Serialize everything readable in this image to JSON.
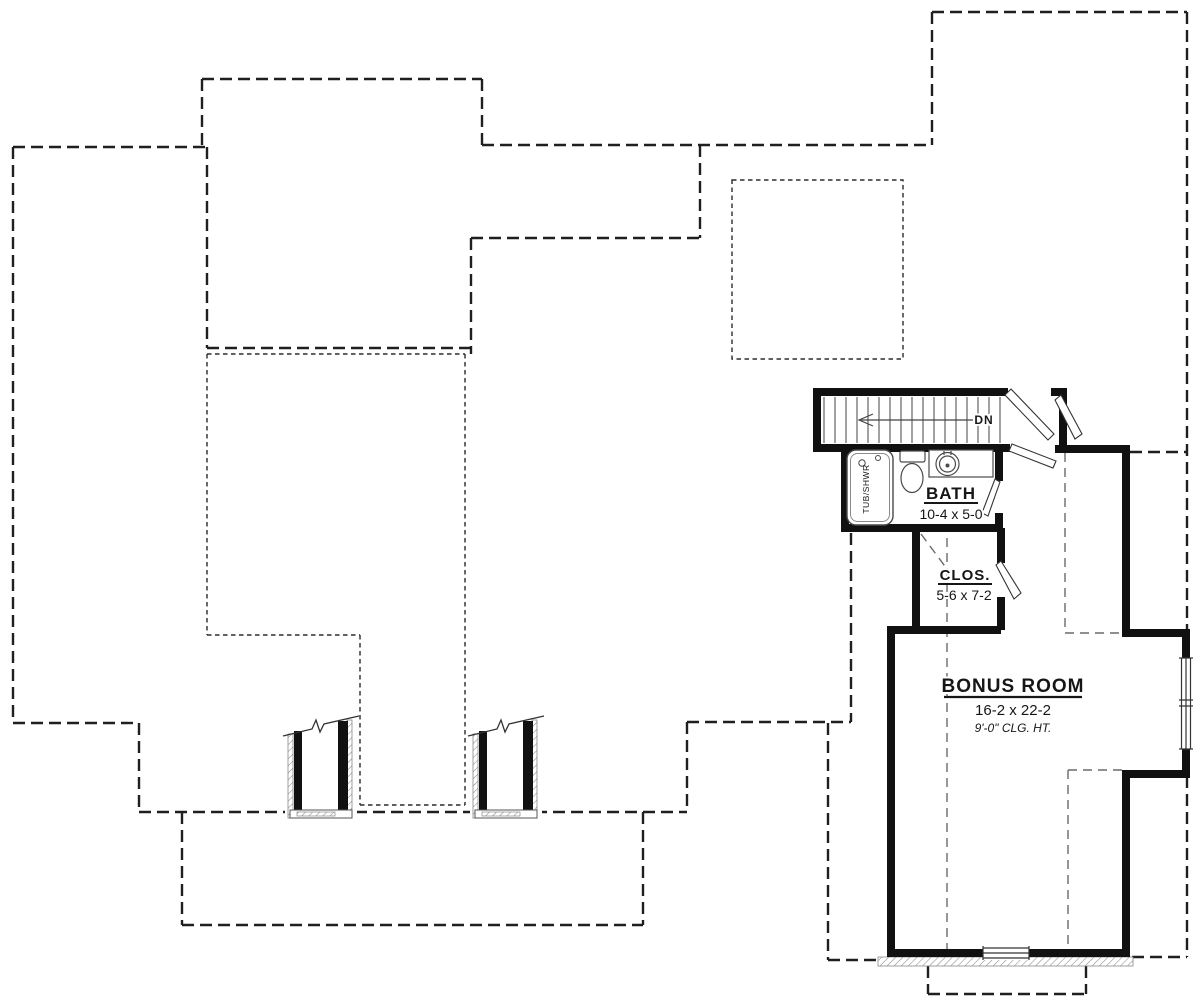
{
  "rooms": {
    "bath": {
      "name": "BATH",
      "dimensions": "10-4 x 5-0"
    },
    "closet": {
      "name": "CLOS.",
      "dimensions": "5-6 x 7-2"
    },
    "bonus": {
      "name": "BONUS ROOM",
      "dimensions": "16-2 x 22-2",
      "ceiling_height": "9'-0\" CLG. HT."
    }
  },
  "stairs": {
    "direction_label": "DN"
  },
  "fixtures": {
    "tub_label": "TUB/SHWR"
  },
  "colors": {
    "background": "#ffffff",
    "wall": "#111111",
    "outline_dash": "#1f1f1f",
    "fine_dash": "#2b2b2b",
    "ceiling_dash": "#6a6a6a",
    "fixture_line": "#4a4a4a",
    "hatch": "#8a8a8a"
  }
}
